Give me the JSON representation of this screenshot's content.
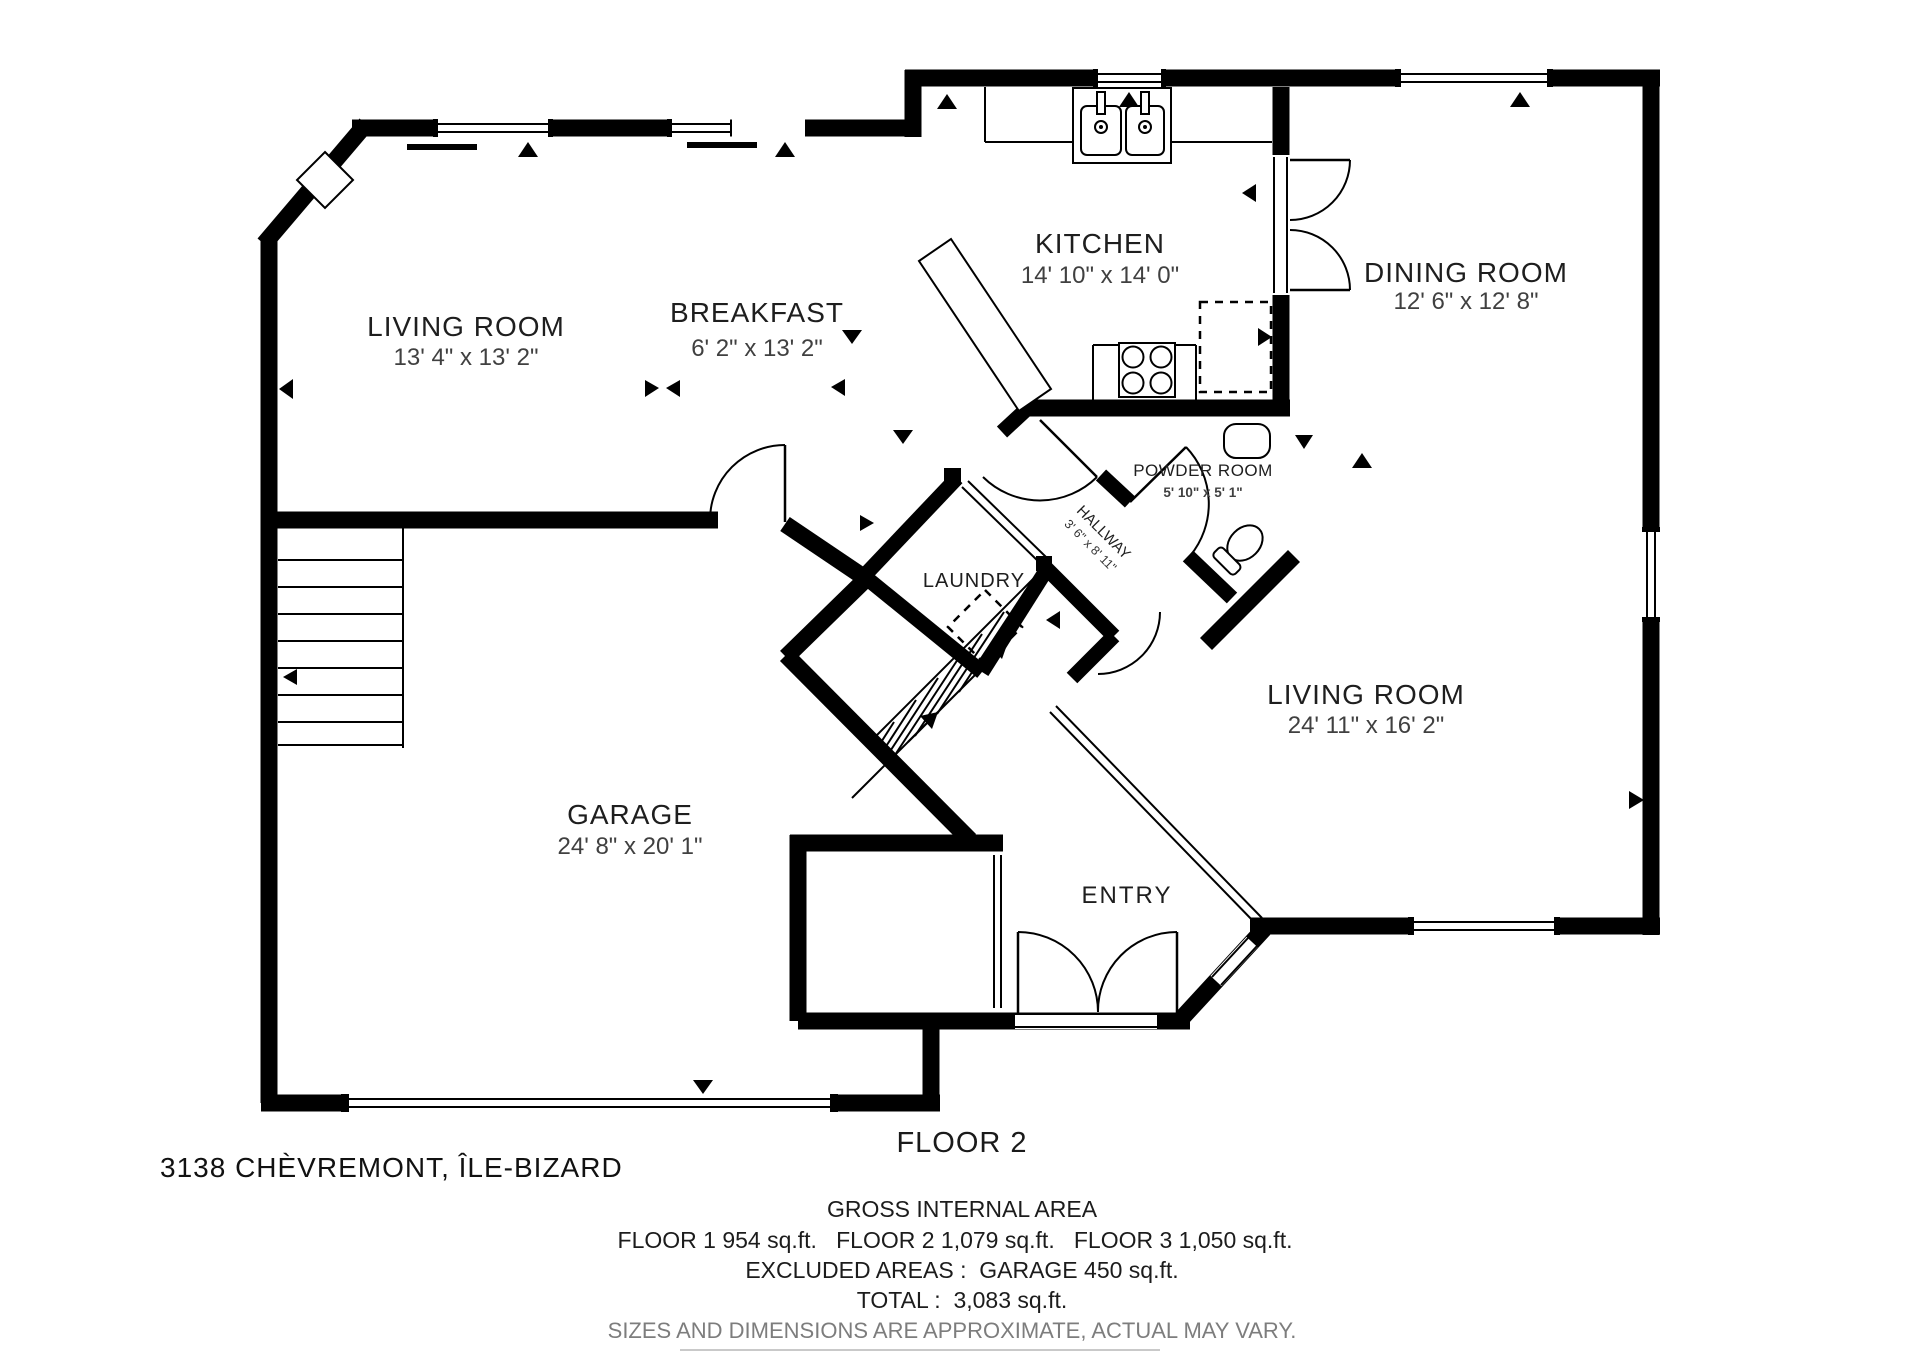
{
  "plan": {
    "floor_caption": "FLOOR 2",
    "address": "3138 CHÈVREMONT, ÎLE-BIZARD",
    "rooms": [
      {
        "name": "LIVING ROOM",
        "dims": "13' 4\" x 13' 2\""
      },
      {
        "name": "BREAKFAST",
        "dims": "6' 2\" x 13' 2\""
      },
      {
        "name": "KITCHEN",
        "dims": "14' 10\" x 14' 0\""
      },
      {
        "name": "DINING ROOM",
        "dims": "12' 6\" x 12' 8\""
      },
      {
        "name": "POWDER ROOM",
        "dims": "5' 10\" x 5' 1\""
      },
      {
        "name": "HALLWAY",
        "dims": "3' 6\" x 8' 11\""
      },
      {
        "name": "LAUNDRY",
        "dims": ""
      },
      {
        "name": "LIVING ROOM",
        "dims": "24' 11\" x 16' 2\""
      },
      {
        "name": "GARAGE",
        "dims": "24' 8\" x 20' 1\""
      },
      {
        "name": "ENTRY",
        "dims": ""
      }
    ],
    "fixtures": [
      "double-sink",
      "cooktop-stove",
      "refrigerator",
      "kitchen-island",
      "toilet",
      "vanity-sink",
      "washer",
      "entry-closet-sliding-door",
      "main-staircase",
      "garage-staircase",
      "fireplace"
    ]
  },
  "footer": {
    "gross_title": "GROSS INTERNAL AREA",
    "floors_line": "FLOOR 1 954 sq.ft.   FLOOR 2 1,079 sq.ft.   FLOOR 3 1,050 sq.ft.",
    "excluded_line": "EXCLUDED AREAS :  GARAGE 450 sq.ft.",
    "total_line": "TOTAL :  3,083 sq.ft.",
    "disclaimer": "SIZES AND DIMENSIONS ARE APPROXIMATE, ACTUAL MAY VARY."
  }
}
